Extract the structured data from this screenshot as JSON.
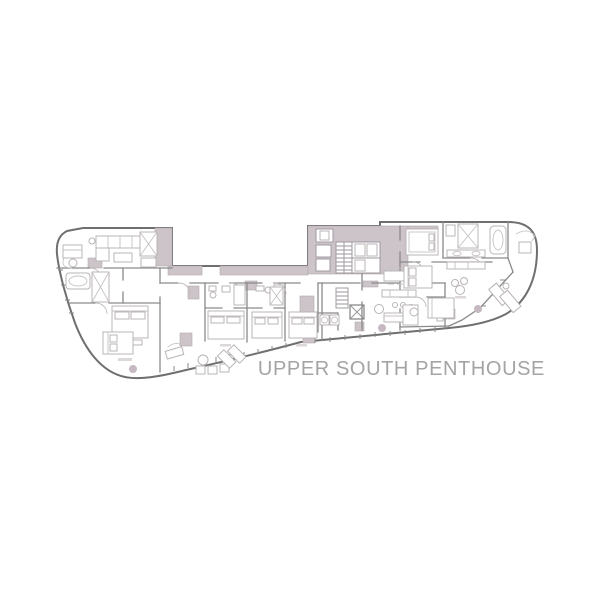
{
  "floorplan": {
    "title": "UPPER SOUTH PENTHOUSE",
    "title_color": "#a5a3a3",
    "colors": {
      "background": "#ffffff",
      "core_fill": "#cdc4ca",
      "outer_wall": "#6f6f6f",
      "interior_wall": "#8a8a8a",
      "furniture_line": "#b9b4b4",
      "accent_dot": "#c6b9c1"
    }
  }
}
